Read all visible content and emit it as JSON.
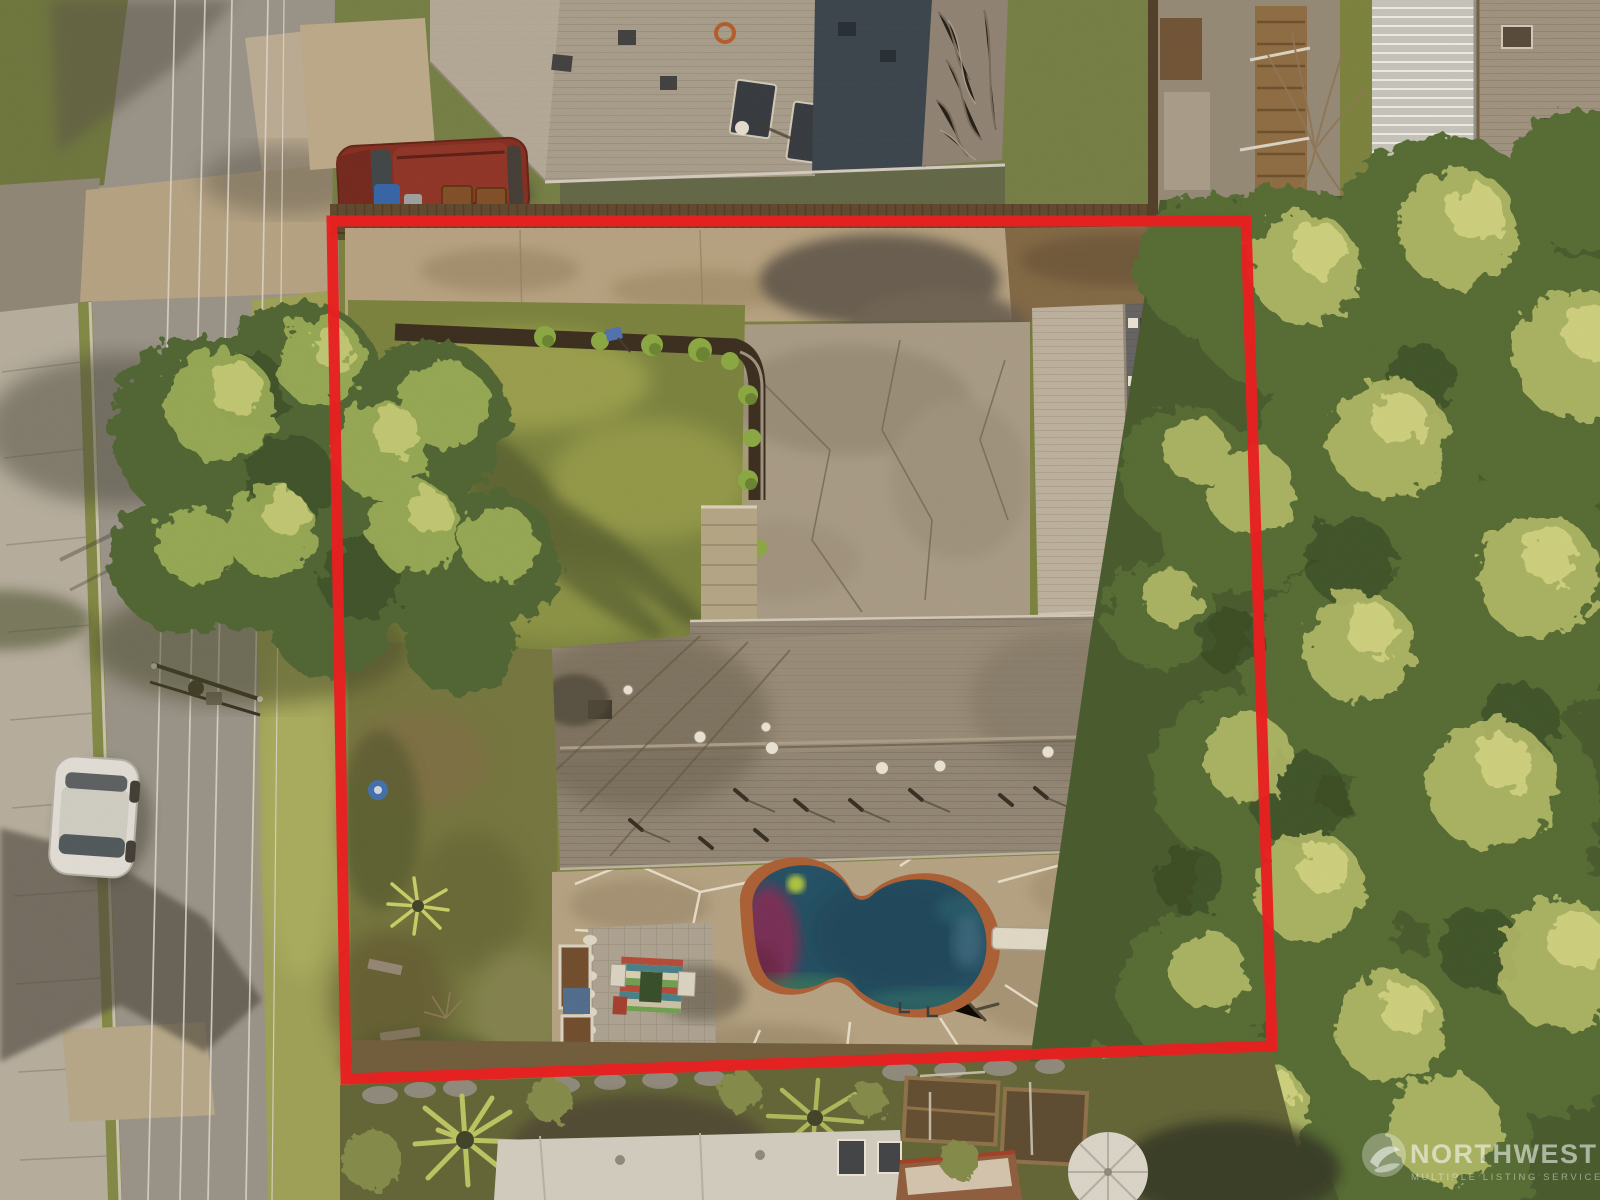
{
  "photo": {
    "kind": "aerial-drone-photo",
    "subject": "residential-lot-with-red-boundary-outline"
  },
  "boundary": {
    "points": "332,221 1246,221 1272,1046 346,1079",
    "color": "#e8191f",
    "width": "11"
  },
  "watermark": {
    "brand": "NORTHWEST",
    "tagline": "MULTIPLE LISTING SERVICE",
    "logo": "nwmls-globe-icon",
    "text_color": "rgba(255,255,255,0.55)",
    "tagline_color": "rgba(255,255,255,0.45)"
  },
  "palette": {
    "pool_water": "#1b4d68",
    "pool_rim": "#a85c36",
    "asphalt": "#95928c",
    "driveway_concrete": "#b3a184",
    "roof_main_house": "#8d8478",
    "roof_neighbor_tarp_blue": "#33404f",
    "lawn": "#75813f",
    "canopy_dark": "#4f6a36",
    "canopy_light": "#b5bf6e"
  },
  "scene": {
    "street": "street-with-power-lines-left",
    "vehicles": [
      "white-car-parked-street",
      "red-suv-neighbor-driveway"
    ],
    "lot_features": [
      "concrete-driveway",
      "parking-pad",
      "detached-garage-roof",
      "front-lawn-with-hedge",
      "main-house-roof",
      "kidney-shaped-pool",
      "diving-board",
      "paver-patio",
      "conifer-trees"
    ],
    "neighbors": [
      "gray-roof-house-top",
      "tarped-roof-section-top",
      "metal-roof-house-top-right",
      "white-roof-house-bottom",
      "patio-umbrella-bottom",
      "palm-trees-bottom"
    ]
  }
}
